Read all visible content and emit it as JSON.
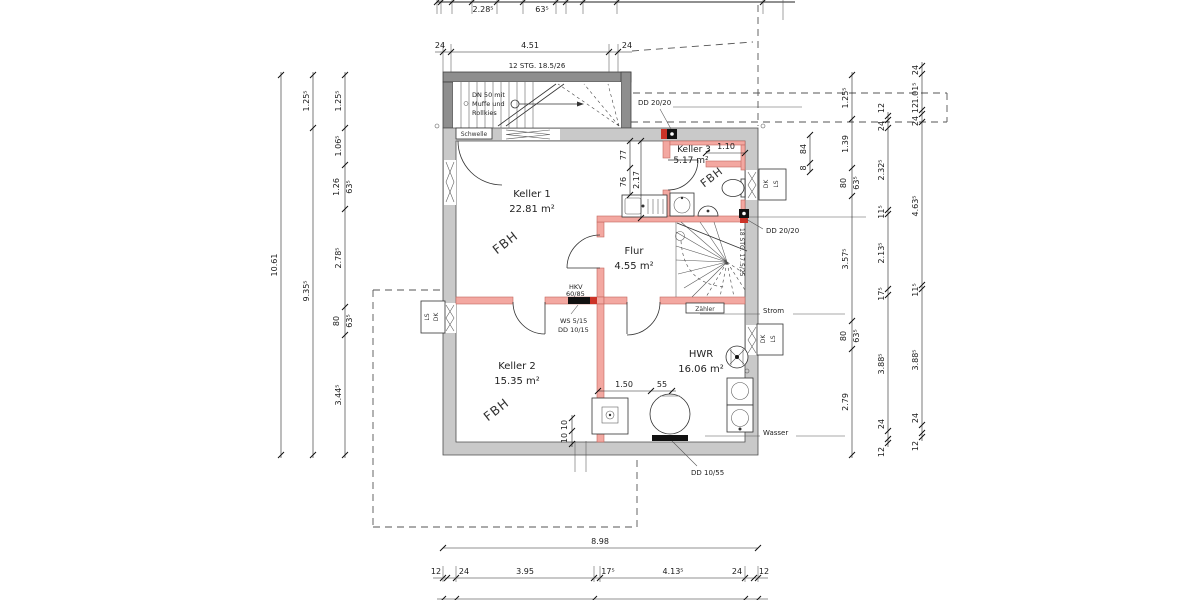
{
  "drawing": {
    "rooms": {
      "keller1": {
        "name": "Keller 1",
        "area": "22.81 m²"
      },
      "keller2": {
        "name": "Keller 2",
        "area": "15.35 m²"
      },
      "keller3": {
        "name": "Keller 3",
        "area": "5.17 m²"
      },
      "flur": {
        "name": "Flur",
        "area": "4.55 m²"
      },
      "hwr": {
        "name": "HWR",
        "area": "16.06 m²"
      }
    },
    "floor_heating": "FBH",
    "annotations": {
      "stair_top": "12 STG. 18.5/26",
      "stair_inner": "18 STG. 17.5/25",
      "dn50_1": "DN 50 mit",
      "dn50_2": "Muffe und",
      "dn50_3": "Rollkies",
      "schwelle": "Schwelle",
      "dd2020": "DD 20/20",
      "hkv": "HKV",
      "hkv_val": "60/85",
      "ws": "WS 5/15",
      "dd1015": "DD 10/15",
      "zaehler": "Zähler",
      "strom": "Strom",
      "wasser": "Wasser",
      "dd1055": "DD 10/55",
      "dk": "DK",
      "ls": "LS"
    },
    "dims": {
      "top_strip": [
        "2.28⁵",
        "63⁵"
      ],
      "top": [
        "24",
        "4.51",
        "24"
      ],
      "left_total": "10.61",
      "left_mid": [
        "1.25⁵",
        "9.35⁵"
      ],
      "left_inner": [
        "1.25⁵",
        "1.06⁵",
        "1.26",
        "63⁵",
        "2.78⁵",
        "80",
        "63⁵",
        "3.44⁵"
      ],
      "right_a": [
        "1.25⁵",
        "1.39",
        "80",
        "63⁵",
        "3.57⁵",
        "80",
        "63⁵",
        "2.79"
      ],
      "right_b": [
        "12",
        "24",
        "2.32⁵",
        "11⁵",
        "2.13⁵",
        "17⁵",
        "3.88⁵",
        "24",
        "12"
      ],
      "right_c": [
        "24",
        "1.01⁵",
        "12",
        "24",
        "4.63⁵",
        "11⁵",
        "3.88⁵",
        "24",
        "12"
      ],
      "niche": [
        "84",
        "8"
      ],
      "inner_vertical": [
        "77",
        "76",
        "2.17"
      ],
      "keller3_width": "1.10",
      "hwr": [
        "1.50",
        "55"
      ],
      "pipes": [
        "10",
        "10"
      ],
      "bottom_total": "8.98",
      "bottom": [
        "12",
        "24",
        "3.95",
        "17⁵",
        "4.13⁵",
        "24",
        "12"
      ]
    }
  }
}
